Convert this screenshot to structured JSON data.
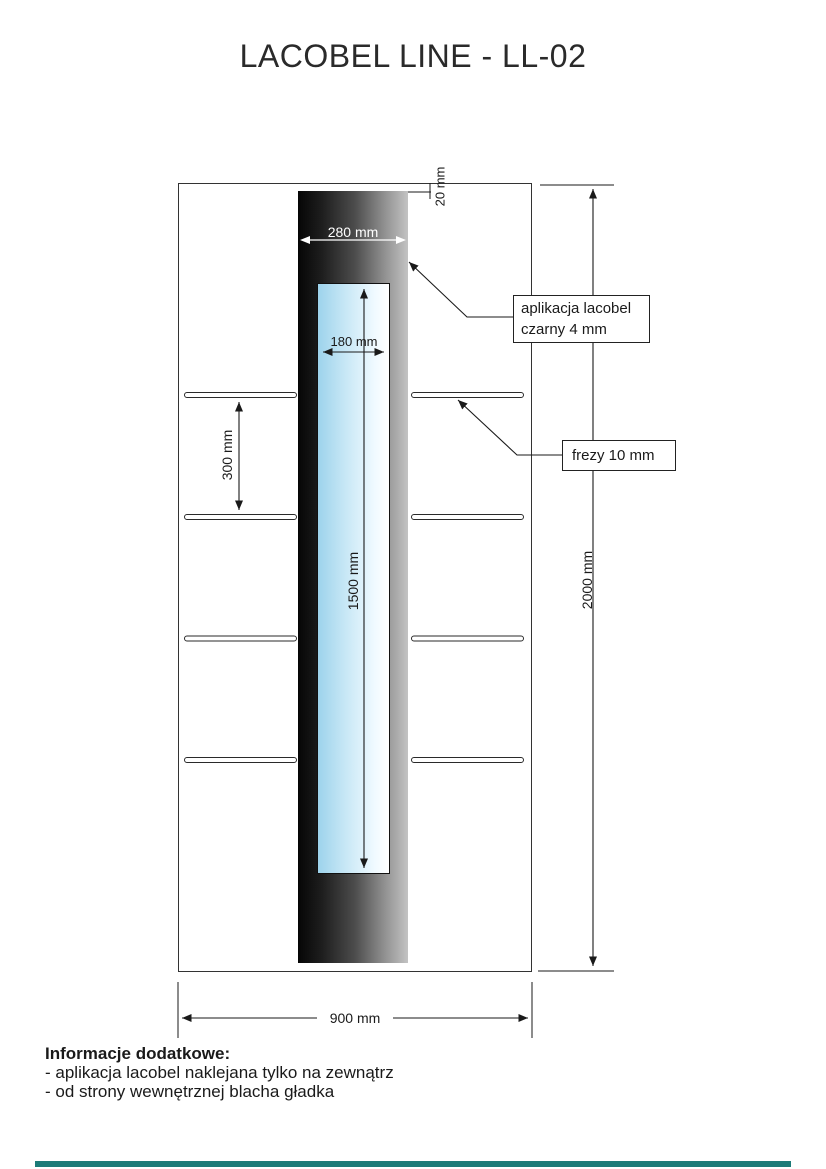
{
  "title": "LACOBEL LINE - LL-02",
  "drawing": {
    "dimensions": {
      "stripe_width": "280 mm",
      "top_offset": "20 mm",
      "glass_width": "180 mm",
      "glass_height": "1500 mm",
      "groove_spacing": "300 mm",
      "total_height": "2000 mm",
      "total_width": "900 mm"
    },
    "labels": {
      "lacobel_line1": "aplikacja lacobel",
      "lacobel_line2": "czarny 4 mm",
      "frezy": "frezy 10 mm"
    },
    "colors": {
      "accent_bar": "#1d7b78",
      "glass_blue": "#9dd3ec",
      "stripe_dark": "#060606",
      "stripe_light": "#c3c3c3",
      "line": "#1a1a1a"
    }
  },
  "footer": {
    "heading": "Informacje dodatkowe:",
    "notes": [
      "- aplikacja lacobel naklejana tylko na zewnątrz",
      "- od strony wewnętrznej blacha gładka"
    ]
  }
}
